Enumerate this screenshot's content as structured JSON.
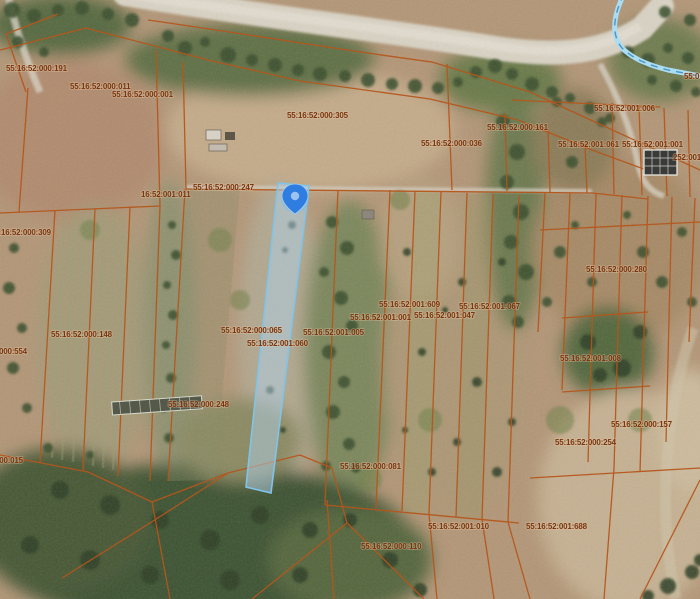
{
  "map": {
    "type": "satellite-cadastral-map",
    "labels": [
      "55:16:52:000:191",
      "55:16:52:000:011",
      "55:16:52:000:001",
      "55:16:52:000:305",
      "55:16:52:000:036",
      "55:16:52:000:161",
      "55:16:52:001:006",
      "55:16:52:001:061",
      "55:16:52:001:001",
      "252:001",
      "55:16:52:000:247",
      "16:52:001:011",
      "55:16:52:000:309",
      "55:16:52:000:280",
      "55:16:52:001:609",
      "55:16:52:001:067",
      "55:16:52:001:001",
      "55:16:52:001:047",
      "55:16:52:000:065",
      "55:16:52:001:005",
      "55:16:52:001:060",
      "55:16:52:000:148",
      "52:000:554",
      "55:16:52:001:008",
      "55:16:52:000:248",
      "55:16:52:000:157",
      "55:16:52:000:254",
      "55:16:52:000:081",
      "52:000:015",
      "55:16:52:001:010",
      "55:16:52:001:688",
      "55:16:52:000:110",
      "55:0"
    ],
    "pin": {
      "icon": "location-pin",
      "color": "#2f7de0",
      "inner_dot_color": "#9cc3ef"
    },
    "colors": {
      "parcel_line": "#b5561c",
      "label_text": "#7a350f",
      "selection_fill": "rgba(176,208,232,0.5)",
      "selection_stroke": "#7fc4ec",
      "stream": "#aadcf2",
      "road": "#d9d3c4",
      "terrain_base": "#b39677"
    }
  }
}
